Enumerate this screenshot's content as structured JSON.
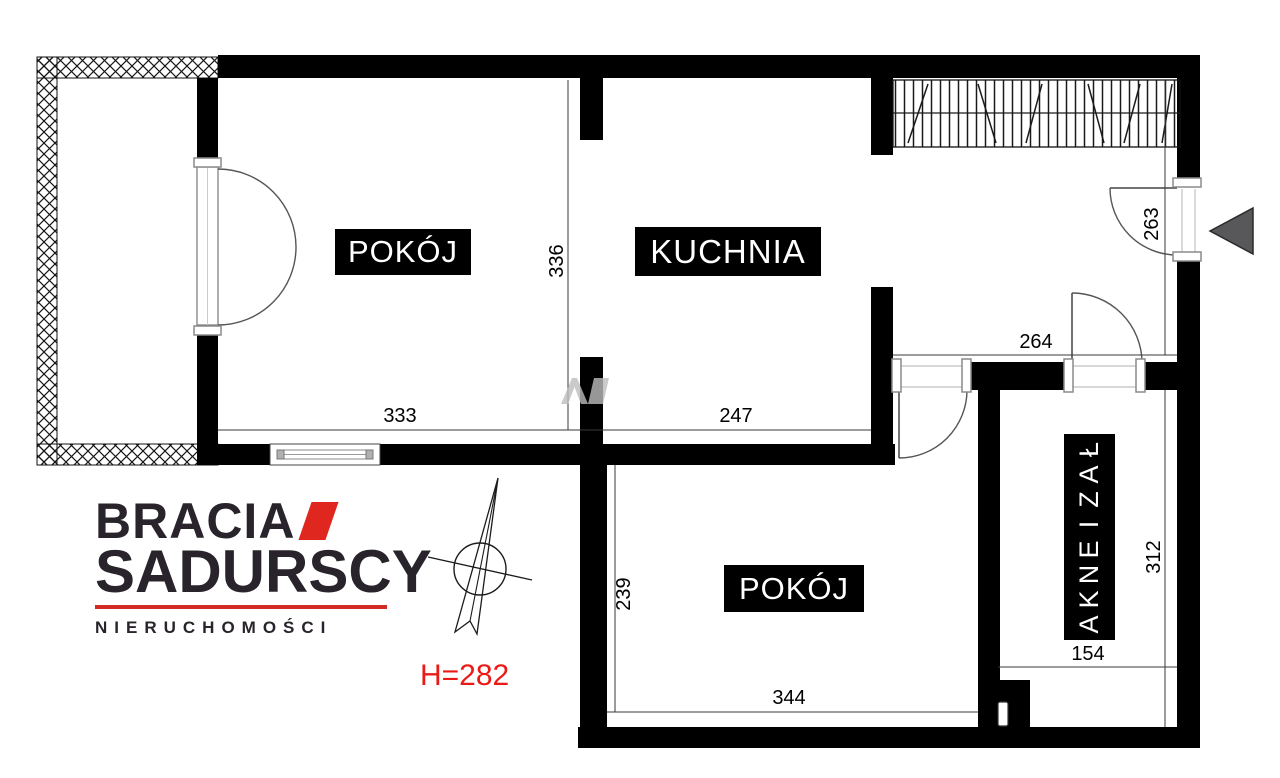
{
  "plan": {
    "labels": {
      "room1": "POKÓJ",
      "kitchen": "KUCHNIA",
      "room2": "POKÓJ",
      "bathroom": "ŁAZIENKA"
    },
    "dims": {
      "room1_width": "333",
      "room1_depth": "336",
      "kitchen_width": "247",
      "hall_width": "264",
      "entry_depth": "263",
      "bathroom_depth": "312",
      "bathroom_width": "154",
      "room2_depth": "239",
      "room2_width": "344"
    },
    "ceiling_height": "H=282"
  },
  "logo": {
    "brand_line1": "BRACIA",
    "brand_line2": "SADURSCY",
    "tagline": "NIERUCHOMOŚCI"
  },
  "colors": {
    "wall": "#000000",
    "logo_dark": "#29242b",
    "logo_red": "#e0271f",
    "height_red": "#ea1a17",
    "entry_arrow": "#58585a"
  }
}
